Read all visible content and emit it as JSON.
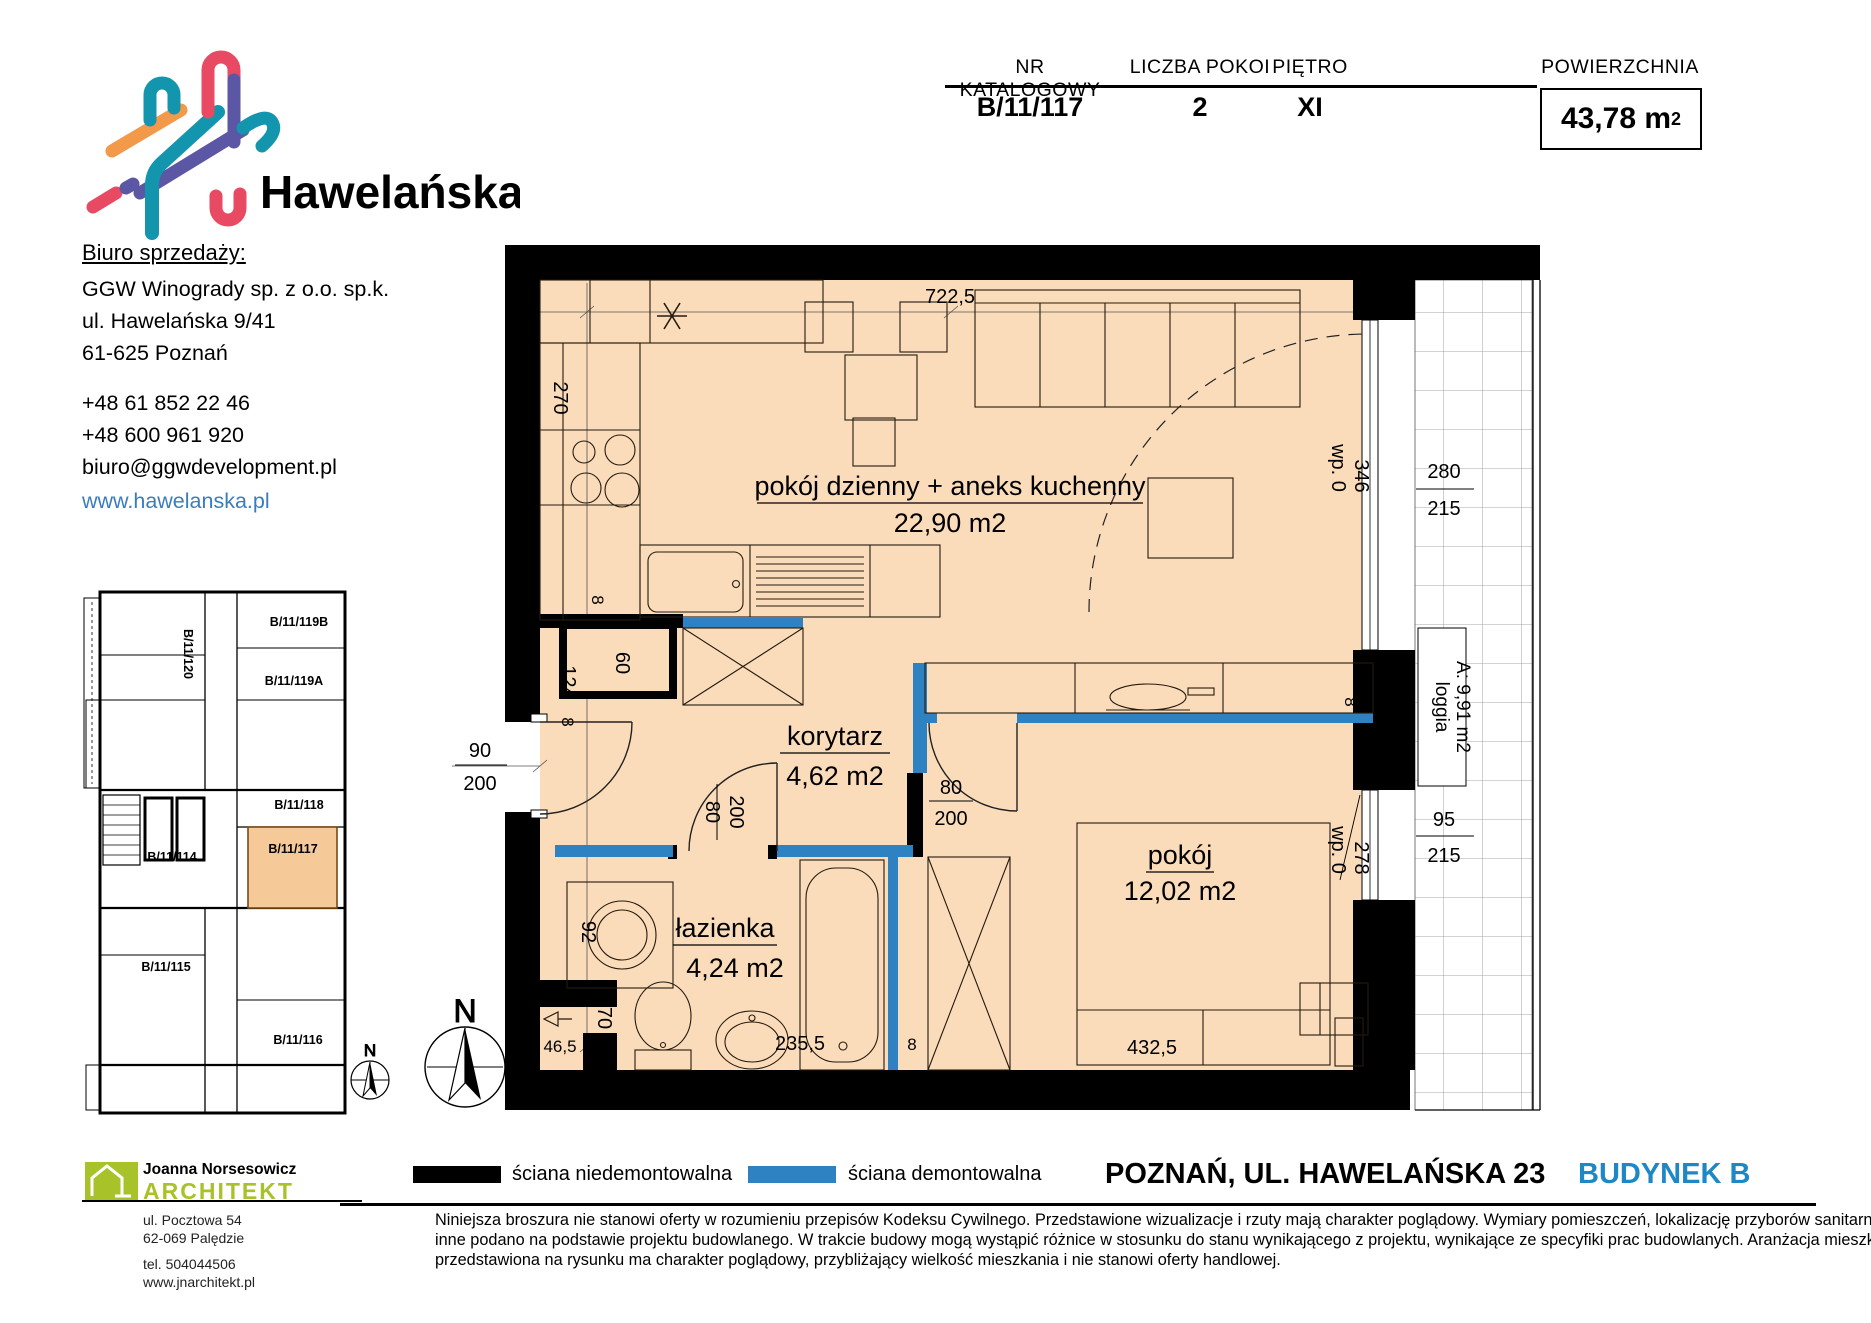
{
  "brand": {
    "name": "Hawelańska",
    "office_heading": "Biuro sprzedaży:",
    "company": "GGW Winogrady sp. z o.o. sp.k.",
    "street": "ul. Hawelańska 9/41",
    "city": "61-625 Poznań",
    "phone1": "+48 61 852 22 46",
    "phone2": "+48 600 961 920",
    "email": "biuro@ggwdevelopment.pl",
    "website": "www.hawelanska.pl"
  },
  "info_table": {
    "col1_label": "NR KATALOGOWY",
    "col1_value": "B/11/117",
    "col2_label": "LICZBA POKOI",
    "col2_value": "2",
    "col3_label": "PIĘTRO",
    "col3_value": "XI",
    "col4_label": "POWIERZCHNIA",
    "col4_value": "43,78 m",
    "col4_sup": "2"
  },
  "plan": {
    "rooms": {
      "living_name": "pokój dzienny + aneks kuchenny",
      "living_area": "22,90 m2",
      "corridor_name": "korytarz",
      "corridor_area": "4,62 m2",
      "bathroom_name": "łazienka",
      "bathroom_area": "4,24 m2",
      "bedroom_name": "pokój",
      "bedroom_area": "12,02 m2",
      "loggia_name": "loggia",
      "loggia_area": "A: 9,91 m2"
    },
    "dims": {
      "top_width": "722,5",
      "kitchen": "270",
      "shaft": "60",
      "d8a": "8",
      "entry_w": "90",
      "entry_h": "200",
      "d124": "124",
      "d8b": "8",
      "bath_door_w": "80",
      "bath_door_h": "200",
      "room_door_w": "80",
      "room_door_h": "200",
      "washer": "92",
      "d70": "70",
      "d465": "46,5",
      "d2355": "235,5",
      "d8c": "8",
      "bed_w": "432,5",
      "d28": "28",
      "d8d": "8",
      "wp1": "wp. 0",
      "wp1_len": "346",
      "win1_w": "280",
      "win1_h": "215",
      "wp2": "wp. 0",
      "wp2_len": "278",
      "win2_w": "95",
      "win2_h": "215"
    },
    "north": "N"
  },
  "mini_plan": {
    "units": [
      "B/11/119B",
      "B/11/120",
      "B/11/119A",
      "B/11/118",
      "B/11/114",
      "B/11/117",
      "B/11/115",
      "B/11/116"
    ],
    "north": "N"
  },
  "legend": {
    "solid_wall": "ściana niedemontowalna",
    "removable_wall": "ściana demontowalna"
  },
  "location": {
    "address": "POZNAŃ, UL. HAWELAŃSKA 23",
    "building": "BUDYNEK B"
  },
  "disclaimer": {
    "line1": "Niniejsza broszura nie stanowi oferty w rozumieniu przepisów Kodeksu Cywilnego. Przedstawione wizualizacje i rzuty mają charakter poglądowy. Wymiary pomieszczeń, lokalizację przyborów sanitarnych i",
    "line2": "inne podano na podstawie projektu budowlanego. W trakcie budowy mogą wystąpić różnice w stosunku do stanu wynikającego z projektu, wynikające ze specyfiki prac budowlanych. Aranżacja mieszkania",
    "line3": "przedstawiona na rysunku ma charakter poglądowy, przybliżający wielkość mieszkania i nie stanowi oferty handlowej."
  },
  "architect": {
    "name": "Joanna Norsesowicz",
    "title": "ARCHITEKT",
    "street": "ul. Pocztowa 54",
    "city": "62-069 Palędzie",
    "phone": "tel. 504044506",
    "website": "www.jnarchitekt.pl"
  },
  "colors": {
    "room_fill": "#fbdcba",
    "highlight_fill": "#f6c998",
    "wall_black": "#000000",
    "wall_blue": "#2e82c2",
    "brand_teal": "#1295ad",
    "link_blue": "#3a7dbd",
    "building_blue": "#1e88c7",
    "architect_green": "#a8c32a"
  }
}
